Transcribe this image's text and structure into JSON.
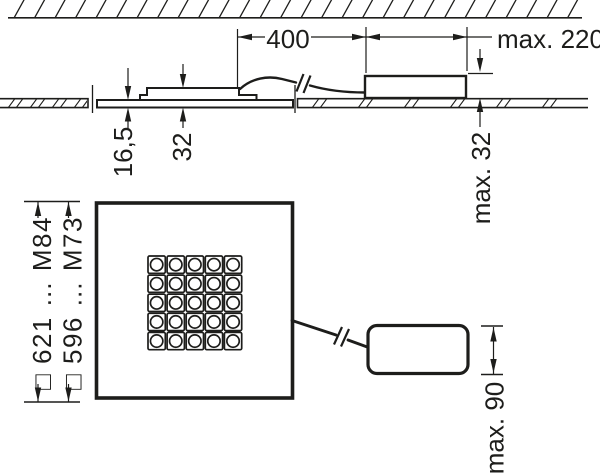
{
  "drawing": {
    "background": "#ffffff",
    "line_color": "#1d1d1b",
    "section_view": {
      "dim_cable_length": "400",
      "dim_driver_length": "max. 220",
      "dim_driver_height": "max. 32",
      "dim_recess_depth": "16,5",
      "dim_panel_height": "32"
    },
    "plan_view": {
      "dim_outer": "□ 621 … M84",
      "dim_inner": "□ 596 … M73",
      "dim_driver_width": "max. 90",
      "led_grid": {
        "rows": 5,
        "cols": 5
      }
    }
  }
}
